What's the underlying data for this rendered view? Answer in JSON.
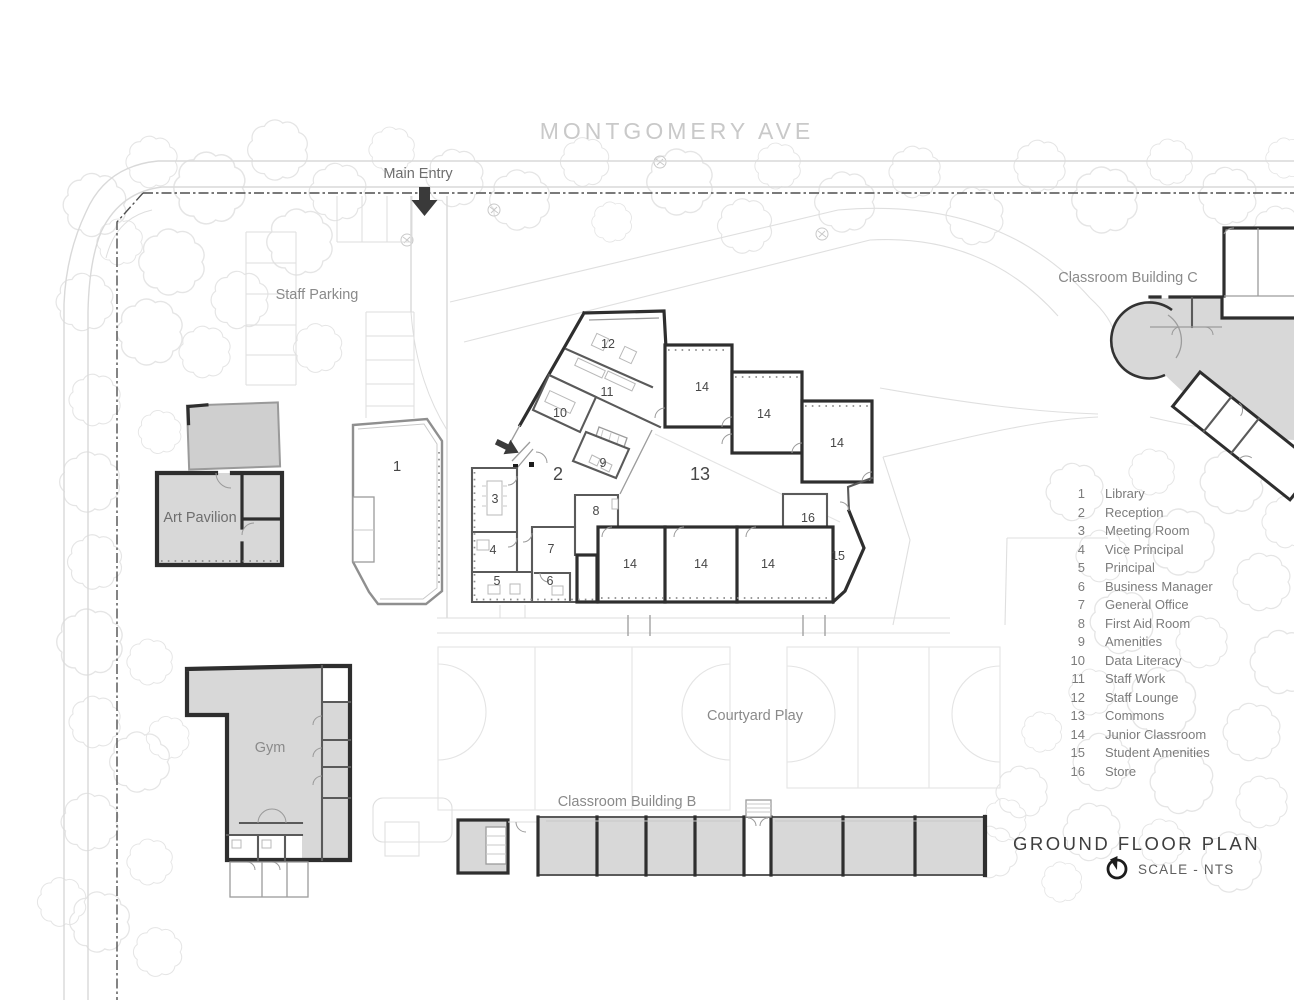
{
  "title_block": {
    "title": "GROUND FLOOR PLAN",
    "scale": "SCALE - NTS",
    "north_icon": "north-arrow"
  },
  "street": {
    "name": "MONTGOMERY AVE"
  },
  "site_labels": {
    "main_entry": "Main Entry",
    "staff_parking": "Staff Parking",
    "classroom_building_c": "Classroom Building C",
    "classroom_building_b": "Classroom Building B",
    "art_pavilion": "Art Pavilion",
    "gym": "Gym",
    "courtyard_play": "Courtyard Play"
  },
  "room_numbers": {
    "library": "1",
    "reception": "2",
    "meeting_room": "3",
    "vice_principal": "4",
    "principal": "5",
    "business_manager": "6",
    "general_office": "7",
    "first_aid_room": "8",
    "amenities": "9",
    "data_literacy": "10",
    "staff_work": "11",
    "staff_lounge": "12",
    "commons": "13",
    "junior_classroom": "14",
    "student_amenities": "15",
    "store": "16"
  },
  "legend": {
    "items": [
      {
        "num": "1",
        "name": "Library"
      },
      {
        "num": "2",
        "name": "Reception"
      },
      {
        "num": "3",
        "name": "Meeting Room"
      },
      {
        "num": "4",
        "name": "Vice Principal"
      },
      {
        "num": "5",
        "name": "Principal"
      },
      {
        "num": "6",
        "name": "Business Manager"
      },
      {
        "num": "7",
        "name": "General Office"
      },
      {
        "num": "8",
        "name": "First Aid Room"
      },
      {
        "num": "9",
        "name": "Amenities"
      },
      {
        "num": "10",
        "name": "Data Literacy"
      },
      {
        "num": "11",
        "name": "Staff Work"
      },
      {
        "num": "12",
        "name": "Staff Lounge"
      },
      {
        "num": "13",
        "name": "Commons"
      },
      {
        "num": "14",
        "name": "Junior Classroom"
      },
      {
        "num": "15",
        "name": "Student Amenities"
      },
      {
        "num": "16",
        "name": "Store"
      }
    ]
  },
  "colors": {
    "background": "#ffffff",
    "building_fill": "#d8d8d8",
    "building_fill_light": "#cfcfcf",
    "wall": "#2e2e2e",
    "wall_medium": "#5a5a5a",
    "tree_line": "#e5e5e5",
    "site_line": "#d9d9d9",
    "boundary_line": "#4f4f4f",
    "street_text": "#c9c9c9",
    "label_text": "#8a8a8a",
    "number_text": "#474747",
    "title_text": "#3e3e3e"
  }
}
